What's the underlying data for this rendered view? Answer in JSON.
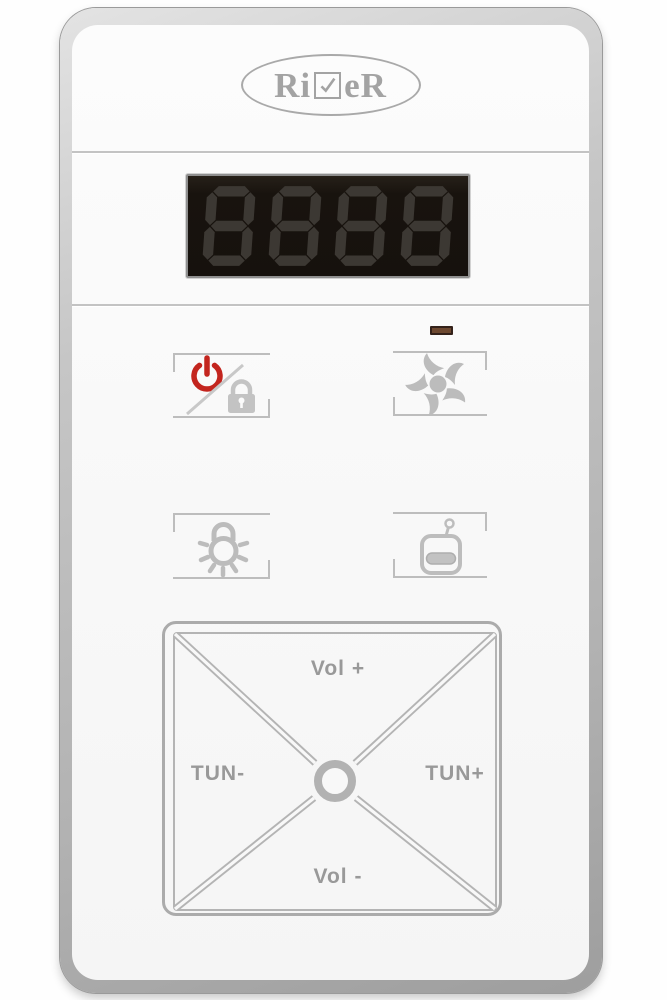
{
  "panel": {
    "brand": {
      "full_name": "RiVeR",
      "text_before_check": "Ri",
      "text_after_check": "eR",
      "check_icon": "checkbox-check-icon"
    },
    "display": {
      "state": "off",
      "digits": [
        "8",
        "8",
        "8",
        "8"
      ]
    },
    "status_led": {
      "state": "off"
    },
    "buttons": [
      {
        "id": "power-lock",
        "icons": [
          "power-icon",
          "slash-icon",
          "lock-icon"
        ]
      },
      {
        "id": "fan",
        "icons": [
          "fan-icon"
        ]
      },
      {
        "id": "light",
        "icons": [
          "light-bulb-icon"
        ]
      },
      {
        "id": "radio",
        "icons": [
          "radio-icon"
        ]
      }
    ],
    "dpad": {
      "up": "Vol +",
      "left": "TUN-",
      "right": "TUN+",
      "down": "Vol -"
    },
    "colors": {
      "power_red": "#c3251e",
      "icon_gray": "#bcbcbc",
      "label_gray": "#999999",
      "frame_gray": "#bdbdbd",
      "bezel_silver": "#b5b5b5",
      "display_background": "#17120d",
      "display_segment": "#3c3833",
      "led_brown": "#6d4830"
    }
  }
}
